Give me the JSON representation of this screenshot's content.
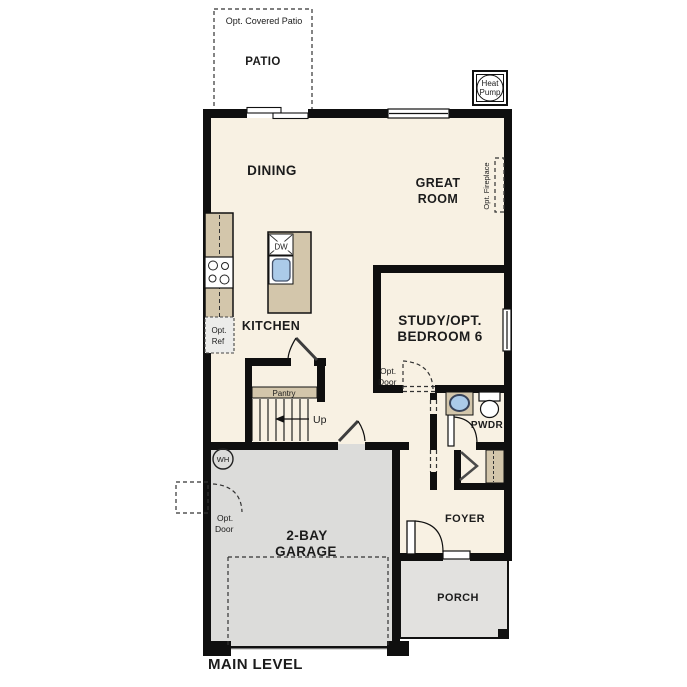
{
  "title": "MAIN LEVEL",
  "labels": {
    "opt_covered_patio": "Opt. Covered Patio",
    "patio": "PATIO",
    "heat_pump_1": "Heat",
    "heat_pump_2": "Pump",
    "dining": "DINING",
    "great_room_1": "GREAT",
    "great_room_2": "ROOM",
    "opt_fireplace": "Opt. Fireplace",
    "dw": "DW",
    "kitchen": "KITCHEN",
    "opt_ref_1": "Opt.",
    "opt_ref_2": "Ref",
    "study_1": "STUDY/OPT.",
    "study_2": "BEDROOM 6",
    "opt_door_1": "Opt.",
    "opt_door_2": "Door",
    "pantry": "Pantry",
    "up": "Up",
    "pwdr": "PWDR",
    "wh": "WH",
    "garage_1": "2-BAY",
    "garage_2": "GARAGE",
    "foyer": "FOYER",
    "porch": "PORCH"
  },
  "colors": {
    "floor": "#f8f1e3",
    "concrete": "#e2e1df",
    "garage_floor": "#dcdcda",
    "cabinet": "#d3c6ab",
    "sink": "#abcbe9",
    "wall": "#0f0f0f"
  }
}
